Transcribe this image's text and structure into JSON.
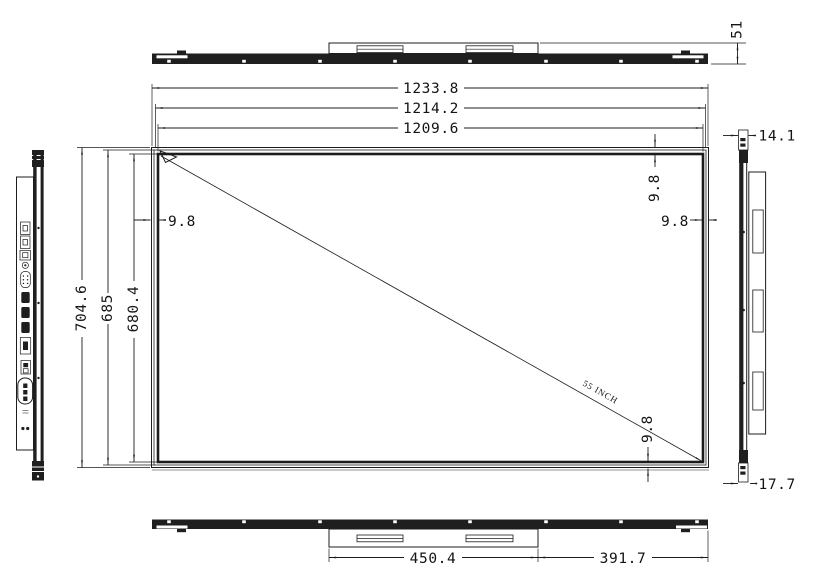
{
  "drawing": {
    "front_view": {
      "overall_width": "1233.8",
      "glass_width": "1214.2",
      "active_width": "1209.6",
      "overall_height": "704.6",
      "glass_height": "685",
      "active_height": "680.4",
      "bezel_left": "9.8",
      "bezel_top": "9.8",
      "bezel_right": "9.8",
      "bezel_bottom": "9.8",
      "diagonal_label": "55 INCH"
    },
    "top_view": {
      "thickness_with_speaker": "51"
    },
    "bottom_view": {
      "speaker_box_width": "450.4",
      "speaker_to_right_edge": "391.7"
    },
    "right_side_view": {
      "top_depth": "14.1",
      "bottom_depth": "17.7"
    },
    "left_side_view": {
      "ports": [
        "usb-port",
        "usb-port",
        "lan-port",
        "audio-jack-port",
        "vga-port",
        "hdmi-port",
        "hdmi-port",
        "hdmi-port",
        "av-port",
        "power-switch",
        "ac-power-inlet"
      ]
    },
    "colors": {
      "line": "#1c1c1c",
      "background": "#ffffff"
    }
  }
}
